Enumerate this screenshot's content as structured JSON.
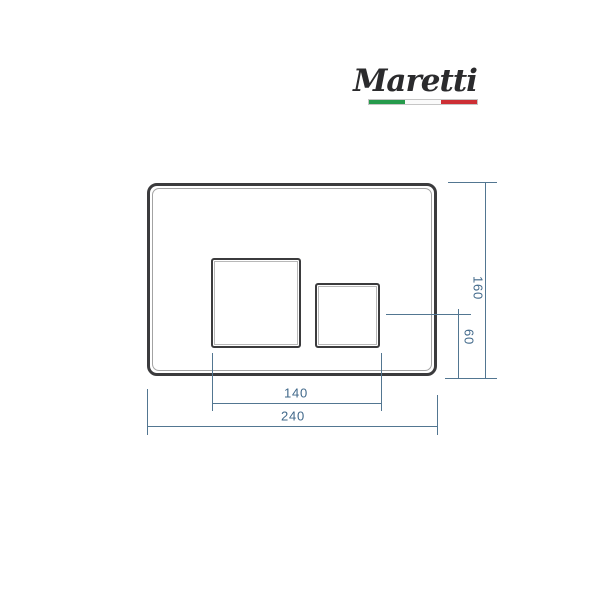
{
  "brand": {
    "name": "Maretti",
    "flag_icon": "italy-flag",
    "flag_colors": {
      "green": "#269b4c",
      "white": "#fafafa",
      "red": "#cd2f35"
    }
  },
  "drawing": {
    "dimensions": {
      "plate_width": "240",
      "plate_height": "160",
      "buttons_span": "140",
      "small_button_offset": "60"
    },
    "colors": {
      "outline": "#3b3b3d",
      "inner_line": "#a3a3a3",
      "dimension_lines": "#527691",
      "dimension_text": "#40688a",
      "logo_ink": "#2b2b2d"
    }
  }
}
